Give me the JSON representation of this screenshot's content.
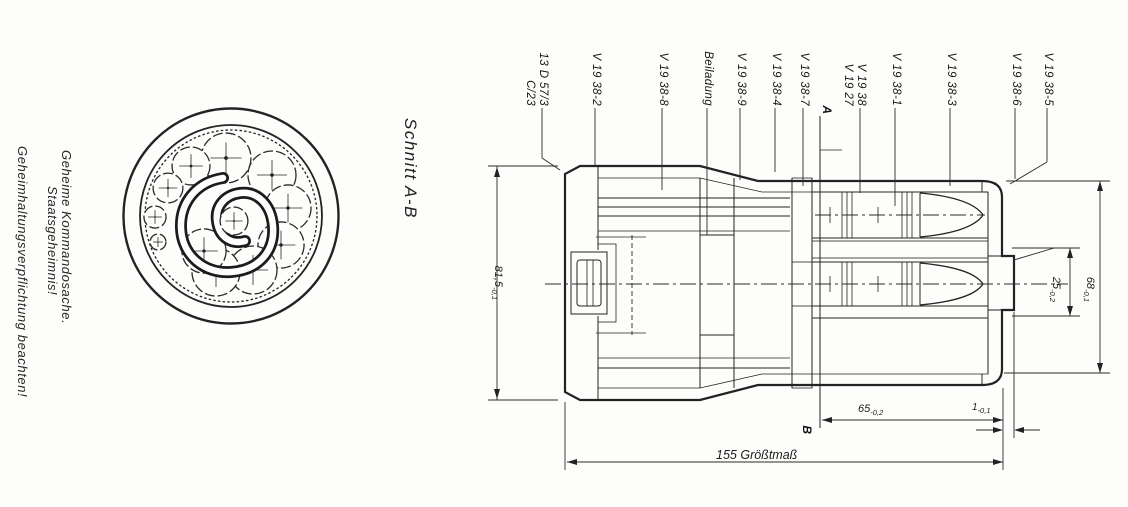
{
  "classification": {
    "line1": "Geheime Kommandosache.",
    "line2": "Staatsgeheimnis!",
    "line3": "Geheimhaltungsverpflichtung beachten!"
  },
  "section_view": {
    "label": "Schnitt A-B"
  },
  "section_markers": {
    "top": "A",
    "bottom": "B"
  },
  "part_labels": [
    {
      "line1": "13 D 57/3",
      "line2": "C/23",
      "leader_x": 542
    },
    {
      "line1": "V 19 38-2",
      "leader_x": 595
    },
    {
      "line1": "V 19 38-8",
      "leader_x": 662
    },
    {
      "line1": "Beiladung",
      "leader_x": 707
    },
    {
      "line1": "V 19 38-9",
      "leader_x": 740
    },
    {
      "line1": "V 19 38-4",
      "leader_x": 775
    },
    {
      "line1": "V 19 38-7",
      "leader_x": 803
    },
    {
      "line1": "V 19 38",
      "line2": "V 19 27",
      "leader_x": 860
    },
    {
      "line1": "V 19 38-1",
      "leader_x": 895
    },
    {
      "line1": "V 19 38-3",
      "leader_x": 950
    },
    {
      "line1": "V 19 38-6",
      "leader_x": 1015
    },
    {
      "line1": "V 19 38-5",
      "leader_x": 1047
    }
  ],
  "dimensions": {
    "body_diameter": {
      "value": "81,5",
      "tolerance": "-0,1"
    },
    "tail_length": {
      "value": "65",
      "tolerance": "-0,2"
    },
    "overall_length": {
      "value": "155",
      "suffix": "Größtmaß"
    },
    "end_step": {
      "value": "1",
      "tolerance": "-0,1"
    },
    "plug_diameter": {
      "value": "25",
      "tolerance": "-0,2"
    },
    "tail_diameter": {
      "value": "68",
      "tolerance": "-0,1"
    }
  },
  "ink_color": "#232323"
}
